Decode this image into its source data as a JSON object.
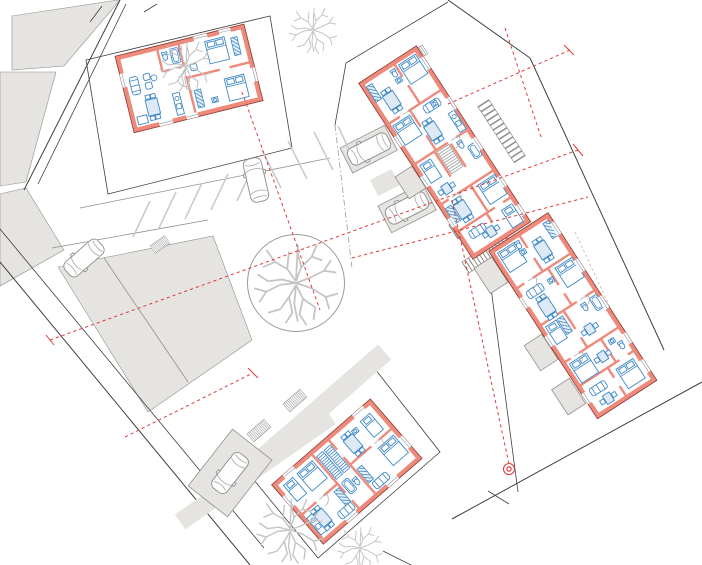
{
  "meta": {
    "description": "architectural site plan, ground floor furniture layout, no visible text labels",
    "canvas_width": 702,
    "canvas_height": 565
  },
  "colors": {
    "bg": "#ffffff",
    "wall_fill": "#ee8a7c",
    "wall_edge": "#8a3a30",
    "furniture": "#3f88c5",
    "furniture_light": "#ddeaf6",
    "line_dark": "#3f3f3f",
    "line_mid": "#8f8f8f",
    "line_light": "#c9c9c9",
    "gray_fill": "#e6e4e1",
    "tree_gray": "#c4c4c4",
    "axis_red": "#e03a3a"
  },
  "elements": {
    "buildings": [
      {
        "id": "house-northwest",
        "type": "detached-house",
        "units": 1
      },
      {
        "id": "apartments-north",
        "type": "apartment-slab",
        "units": 5
      },
      {
        "id": "apartments-east",
        "type": "apartment-slab",
        "units": 5
      },
      {
        "id": "duplex-south",
        "type": "duplex-house",
        "units": 2
      }
    ],
    "landscape": {
      "planted_circle": {
        "cx": 296,
        "cy": 283,
        "r": 48
      },
      "branch_trees": 4
    },
    "vehicles": {
      "cars": 5
    },
    "parking": {
      "striped_stalls": 9,
      "parking_pads": 3
    },
    "red_axis_lines": {
      "count": 7,
      "style": "dashed"
    },
    "survey_marker": {
      "x": 509,
      "y": 469
    }
  }
}
